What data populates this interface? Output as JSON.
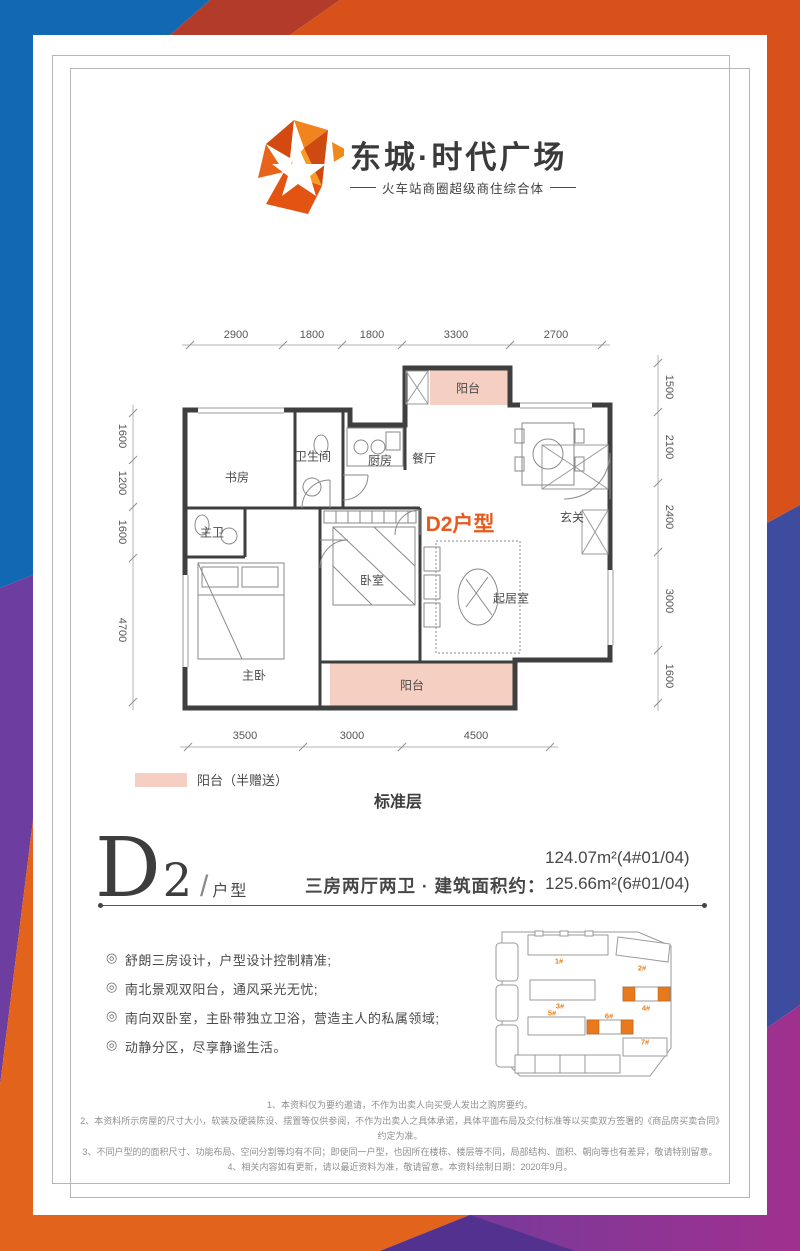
{
  "logo": {
    "title": "东城·时代广场",
    "subtitle": "火车站商圈超级商住综合体"
  },
  "floorplan": {
    "unit_tag": "D2户型",
    "rooms": {
      "study": "书房",
      "bath": "卫生间",
      "kitchen": "厨房",
      "dining": "餐厅",
      "balcony_top": "阳台",
      "foyer": "玄关",
      "master_bath": "主卫",
      "bedroom": "卧室",
      "living": "起居室",
      "master_bedroom": "主卧",
      "balcony_bottom": "阳台"
    },
    "dims": {
      "top": [
        "2900",
        "1800",
        "1800",
        "3300",
        "2700"
      ],
      "right": [
        "1500",
        "2100",
        "2400",
        "3000",
        "1600"
      ],
      "left": [
        "1600",
        "1200",
        "1600",
        "4700"
      ],
      "bottom": [
        "3500",
        "3000",
        "4500"
      ]
    },
    "legend_label": "阳台（半赠送）",
    "floor_label": "标准层"
  },
  "unit": {
    "letter": "D",
    "number": "2",
    "slash": "/",
    "suffix": "户型",
    "desc": "三房两厅两卫 · 建筑面积约：",
    "areas": [
      "124.07m²(4#01/04)",
      "125.66m²(6#01/04)"
    ]
  },
  "features": {
    "bullet": "◎",
    "items": [
      "舒朗三房设计，户型设计控制精准;",
      "南北景观双阳台，通风采光无忧;",
      "南向双卧室，主卧带独立卫浴，营造主人的私属领域;",
      "动静分区，尽享静谧生活。"
    ]
  },
  "sitemap": {
    "buildings": [
      "1#",
      "2#",
      "3#",
      "4#",
      "5#",
      "6#",
      "7#"
    ]
  },
  "disclaimers": [
    "1、本资料仅为要约邀请，不作为出卖人向买受人发出之购房要约。",
    "2、本资料所示房屋的尺寸大小，软装及硬装陈设、摆置等仅供参阅，不作为出卖人之具体承诺，具体平面布局及交付标准等以买卖双方签署的《商品房买卖合同》约定为准。",
    "3、不同户型的的面积尺寸、功能布局、空间分割等均有不同；即使同一户型，也因所在楼栋、楼层等不同，局部结构、面积、朝向等也有差异，敬请特别留意。",
    "4、相关内容如有更新，请以最近资料为准，敬请留意。本资料绘制日期：2020年9月。"
  ],
  "colors": {
    "accent": "#e8591c",
    "balcony_pink": "#f5cfc1",
    "blue": "#1168b3",
    "red": "#b23b2a",
    "orange": "#d8511b",
    "indigo": "#3d4c9e",
    "purple": "#6d3d9f",
    "magenta": "#a0308e"
  }
}
